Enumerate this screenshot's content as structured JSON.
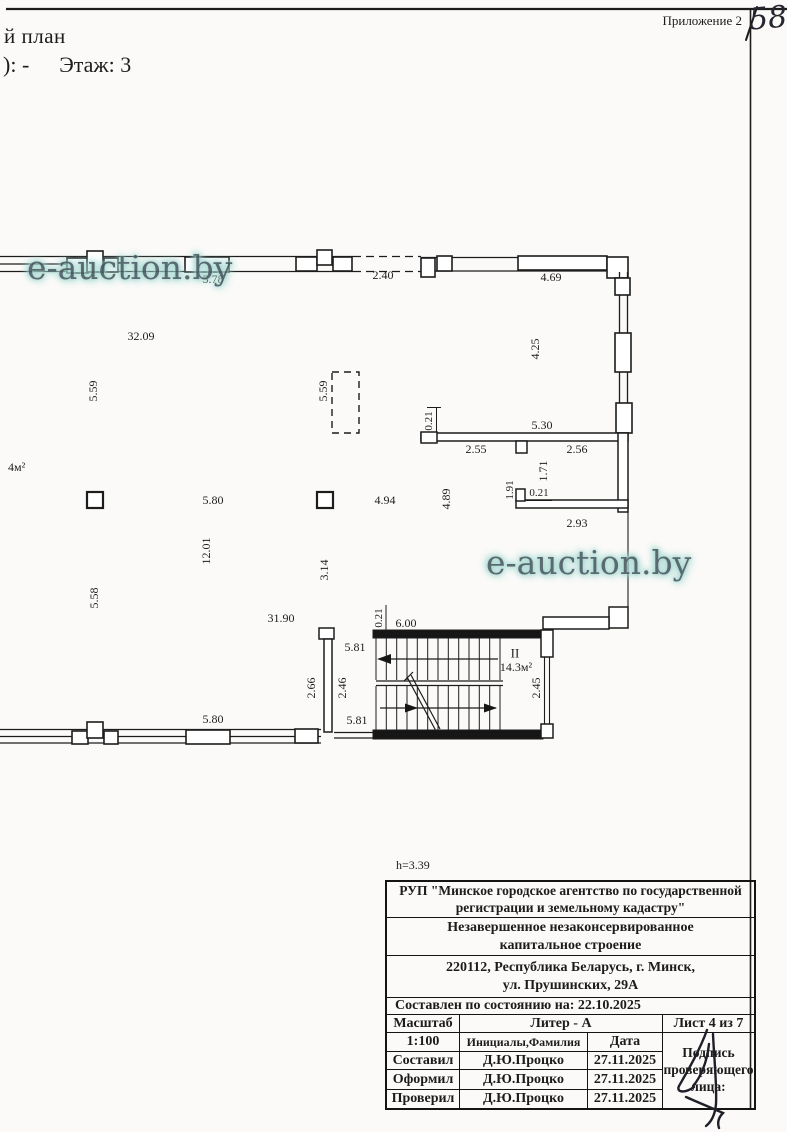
{
  "header": {
    "appendix": "Приложение 2",
    "sheet_number_hand": "58",
    "title_cut_line1": "й план",
    "title_cut_line2_prefix": "): -",
    "floor_label": "Этаж: 3"
  },
  "watermark": {
    "text": "e-auction.by"
  },
  "colors": {
    "ink": "#1c1c1c",
    "paper": "#fbfaf8",
    "watermark_text": "#4d5e66",
    "watermark_glow": "#9ed4cd"
  },
  "plan": {
    "dims": {
      "top_578": "5.78",
      "top_240": "2.40",
      "top_469": "4.69",
      "hall_3209": "32.09",
      "v_425": "4.25",
      "v_559_left": "5.59",
      "v_559_mid": "5.59",
      "v_021_room_top": "0.21",
      "h_530": "5.30",
      "h_255": "2.55",
      "h_256": "2.56",
      "v_171": "1.71",
      "v_191": "1.91",
      "h_021_room": "0.21",
      "v_489": "4.89",
      "h_494": "4.94",
      "h_580_mid": "5.80",
      "h_293": "2.93",
      "v_1201": "12.01",
      "v_314": "3.14",
      "v_558": "5.58",
      "h_3190": "31.90",
      "v_021_stair": "0.21",
      "h_600": "6.00",
      "h_581_top": "5.81",
      "v_266": "2.66",
      "v_246": "2.46",
      "v_245": "2.45",
      "h_581_bot": "5.81",
      "h_580_bot": "5.80"
    },
    "labels": {
      "area_left": "4м²",
      "stair_number": "II",
      "stair_area": "14.3м²",
      "height_note": "h=3.39"
    }
  },
  "title_block": {
    "org_line1": "РУП \"Минское городское агентство по государственной",
    "org_line2": "регистрации и земельному кадастру\"",
    "object_line1": "Незавершенное незаконсервированное",
    "object_line2": "капитальное строение",
    "address_line1": "220112, Республика Беларусь, г. Минск,",
    "address_line2": "ул. Прушинских, 29А",
    "as_of": "Составлен по состоянию на: 22.10.2025",
    "scale_label": "Масштаб",
    "scale_value": "1:100",
    "liter": "Литер - А",
    "sheet": "Лист 4 из 7",
    "columns": {
      "name": "Инициалы,Фамилия",
      "date": "Дата"
    },
    "sign_note": "Подпись проверяющего лица:",
    "rows": [
      {
        "role": "Составил",
        "name": "Д.Ю.Процко",
        "date": "27.11.2025"
      },
      {
        "role": "Оформил",
        "name": "Д.Ю.Процко",
        "date": "27.11.2025"
      },
      {
        "role": "Проверил",
        "name": "Д.Ю.Процко",
        "date": "27.11.2025"
      }
    ]
  }
}
